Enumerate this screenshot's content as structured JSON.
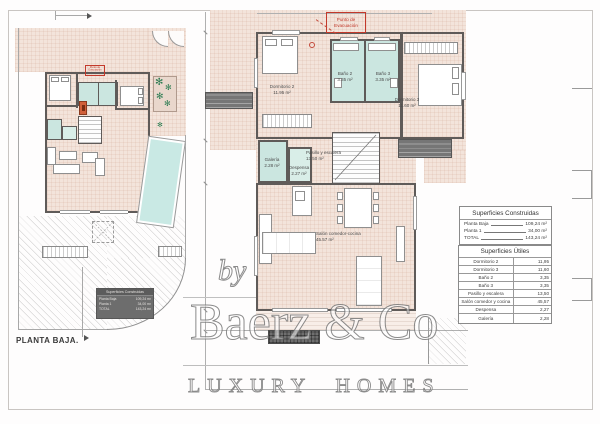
{
  "left_plan": {
    "title": "PLANTA BAJA.",
    "evacuation_label": "Punto de Evacuación"
  },
  "right_plan": {
    "evacuation_label": "Punto de Evacuación",
    "rooms": {
      "dormitorio2": {
        "name": "Dormitorio 2",
        "area": "11.95 m²"
      },
      "bano2": {
        "name": "Baño 2",
        "area": "3.35 m²"
      },
      "bano3": {
        "name": "Baño 3",
        "area": "3.35 m²"
      },
      "dormitorio3": {
        "name": "Dormitorio 3",
        "area": "11.60 m²"
      },
      "pasillo": {
        "name": "Pasillo y escalera",
        "area": "13.50 m²"
      },
      "galeria": {
        "name": "Galería",
        "area": "2.28 m²"
      },
      "despensa": {
        "name": "Despensa",
        "area": "2.27 m²"
      },
      "salon": {
        "name": "Salón comedor-cocina",
        "area": "45.57 m²"
      }
    }
  },
  "summary": {
    "construidas": {
      "title": "Superficies Construidas",
      "rows": [
        {
          "label": "Planta Baja",
          "value": "109,24 m²"
        },
        {
          "label": "Planta 1",
          "value": "34,00 m²"
        },
        {
          "label": "TOTAL",
          "value": "143,24 m²"
        }
      ]
    },
    "utiles": {
      "title": "Superficies Útiles",
      "rows": [
        {
          "label": "Dormitorio 2",
          "value": "11,95"
        },
        {
          "label": "Dormitorio 3",
          "value": "11,60"
        },
        {
          "label": "Baño 2",
          "value": "3,35"
        },
        {
          "label": "Baño 3",
          "value": "3,35"
        },
        {
          "label": "Pasillo y escalera",
          "value": "13,50"
        },
        {
          "label": "Salón comedor y cocina",
          "value": "45,57"
        },
        {
          "label": "Despensa",
          "value": "2,27"
        },
        {
          "label": "Galería",
          "value": "2,28"
        }
      ]
    }
  },
  "watermark": {
    "by": "by",
    "brand": "Baerz & Co",
    "tagline": "LUXURY HOMES"
  },
  "colors": {
    "floor_hatch": "#f3e4db",
    "wet_room": "#cbe6e0",
    "pool": "#c9e9e4",
    "wall": "#5f5b59",
    "plant_green": "#2f7d53",
    "evacuation_red": "#c3392b",
    "legend_gray": "#767676"
  }
}
